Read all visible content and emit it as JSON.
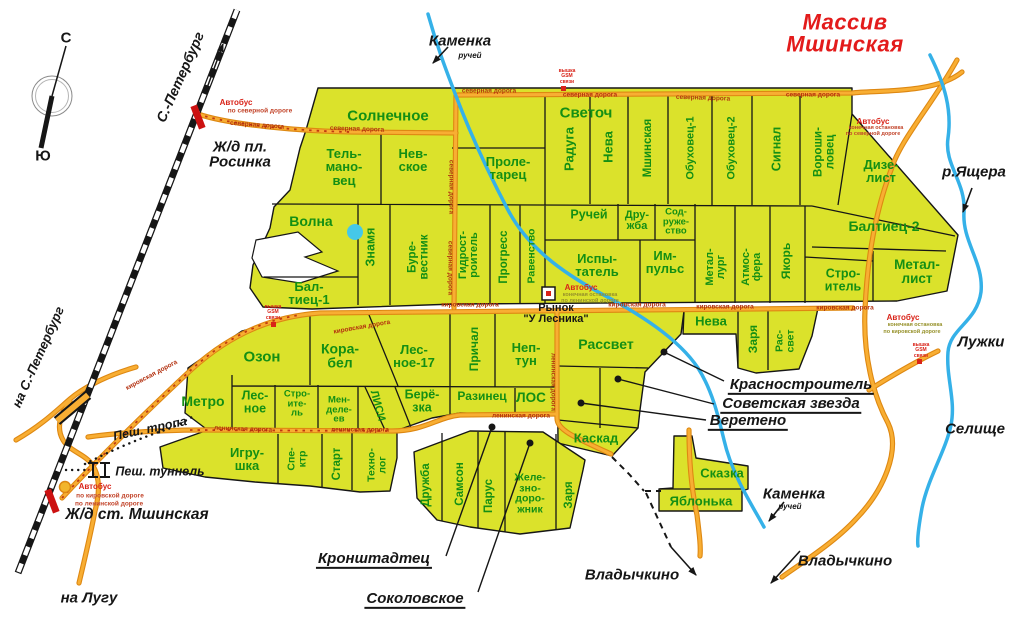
{
  "map_title": "Массив Мшинская",
  "colors": {
    "plot_fill": "#dbe22b",
    "plot_text": "#148f14",
    "road": "#f8ae33",
    "road_casing": "#de8812",
    "river": "#35b1e8",
    "title_red": "#e31b1b",
    "route_dash": "#c03a10"
  },
  "labels": [
    {
      "name": "plot-solnechnoe",
      "text": "Солнечное",
      "x": 388,
      "y": 116,
      "fs": 15,
      "cls": "plot"
    },
    {
      "name": "plot-svetoch",
      "text": "Светоч",
      "x": 586,
      "y": 113,
      "fs": 15,
      "cls": "plot"
    },
    {
      "name": "plot-raduga",
      "text": "Радуга",
      "x": 569,
      "y": 149,
      "rot": -90,
      "fs": 13,
      "cls": "plot"
    },
    {
      "name": "plot-neva-north",
      "text": "Нева",
      "x": 608,
      "y": 147,
      "rot": -90,
      "fs": 13,
      "cls": "plot"
    },
    {
      "name": "plot-mshinskaya",
      "text": "Мшинская",
      "x": 649,
      "y": 148,
      "rot": -90,
      "fs": 11.5,
      "cls": "plot"
    },
    {
      "name": "plot-obukhovec-1",
      "text": "Обуховец-1",
      "x": 691,
      "y": 148,
      "rot": -90,
      "fs": 11,
      "cls": "plot"
    },
    {
      "name": "plot-obukhovec-2",
      "text": "Обуховец-2",
      "x": 732,
      "y": 148,
      "rot": -90,
      "fs": 11,
      "cls": "plot"
    },
    {
      "name": "plot-signal",
      "text": "Сигнал",
      "x": 777,
      "y": 149,
      "rot": -90,
      "fs": 12.5,
      "cls": "plot"
    },
    {
      "name": "plot-voroshilovec",
      "text": "Вороши-\nловец",
      "x": 825,
      "y": 152,
      "rot": -90,
      "fs": 11.5,
      "cls": "plot"
    },
    {
      "name": "plot-dizelist",
      "text": "Дизе-\nлист",
      "x": 881,
      "y": 171,
      "fs": 13,
      "cls": "plot"
    },
    {
      "name": "plot-telmanovec",
      "text": "Тель-\nмано-\nвец",
      "x": 344,
      "y": 167,
      "fs": 13,
      "cls": "plot"
    },
    {
      "name": "plot-nevskoe",
      "text": "Нев-\nское",
      "x": 413,
      "y": 160,
      "fs": 13,
      "cls": "plot"
    },
    {
      "name": "plot-proletarec",
      "text": "Проле-\nтарец",
      "x": 508,
      "y": 168,
      "fs": 13,
      "cls": "plot"
    },
    {
      "name": "plot-ruchej",
      "text": "Ручей",
      "x": 589,
      "y": 215,
      "fs": 12.5,
      "cls": "plot"
    },
    {
      "name": "plot-druzhba-north",
      "text": "Дру-\nжба",
      "x": 637,
      "y": 221,
      "fs": 11,
      "cls": "plot"
    },
    {
      "name": "plot-sodruzhestvo",
      "text": "Сод-\nруже-\nство",
      "x": 676,
      "y": 222,
      "fs": 9.5,
      "cls": "plot"
    },
    {
      "name": "plot-volna",
      "text": "Волна",
      "x": 311,
      "y": 221,
      "fs": 14,
      "cls": "plot"
    },
    {
      "name": "plot-znamya",
      "text": "Знамя",
      "x": 371,
      "y": 247,
      "rot": -90,
      "fs": 12.5,
      "cls": "plot"
    },
    {
      "name": "plot-burevestnik",
      "text": "Буре-\nвестник",
      "x": 419,
      "y": 257,
      "rot": -90,
      "fs": 11.5,
      "cls": "plot"
    },
    {
      "name": "plot-gidrostroitel",
      "text": "Гидрост-\nроитель",
      "x": 469,
      "y": 255,
      "rot": -90,
      "fs": 11,
      "cls": "plot"
    },
    {
      "name": "plot-progress",
      "text": "Прогресс",
      "x": 505,
      "y": 257,
      "rot": -90,
      "fs": 11.5,
      "cls": "plot"
    },
    {
      "name": "plot-ravenstvo",
      "text": "Равенство",
      "x": 532,
      "y": 256,
      "rot": -90,
      "fs": 10.5,
      "cls": "plot"
    },
    {
      "name": "plot-ispytatel",
      "text": "Испы-\nтатель",
      "x": 597,
      "y": 265,
      "fs": 13,
      "cls": "plot"
    },
    {
      "name": "plot-impuls",
      "text": "Им-\nпульс",
      "x": 665,
      "y": 262,
      "fs": 13,
      "cls": "plot"
    },
    {
      "name": "plot-metallurg",
      "text": "Метал-\nлург",
      "x": 716,
      "y": 267,
      "rot": -90,
      "fs": 11,
      "cls": "plot"
    },
    {
      "name": "plot-atmosfera",
      "text": "Атмос-\nфера",
      "x": 752,
      "y": 267,
      "rot": -90,
      "fs": 11,
      "cls": "plot"
    },
    {
      "name": "plot-yakor",
      "text": "Якорь",
      "x": 786,
      "y": 261,
      "rot": -90,
      "fs": 12,
      "cls": "plot"
    },
    {
      "name": "plot-baltiec-2",
      "text": "Балтиец-2",
      "x": 884,
      "y": 226,
      "fs": 14,
      "cls": "plot"
    },
    {
      "name": "plot-metallist",
      "text": "Метал-\nлист",
      "x": 917,
      "y": 272,
      "fs": 13.5,
      "cls": "plot"
    },
    {
      "name": "plot-stroitel-east",
      "text": "Стро-\nитель",
      "x": 843,
      "y": 280,
      "fs": 12.5,
      "cls": "plot"
    },
    {
      "name": "plot-baltiec-1",
      "text": "Бал-\nтиец-1",
      "x": 309,
      "y": 293,
      "fs": 13,
      "cls": "plot"
    },
    {
      "name": "plot-ozon",
      "text": "Озон",
      "x": 262,
      "y": 357,
      "fs": 15,
      "cls": "plot"
    },
    {
      "name": "plot-korabel",
      "text": "Кора-\nбел",
      "x": 340,
      "y": 356,
      "fs": 14,
      "cls": "plot"
    },
    {
      "name": "plot-lesnoe-17",
      "text": "Лес-\nное-17",
      "x": 414,
      "y": 356,
      "fs": 13,
      "cls": "plot"
    },
    {
      "name": "plot-prichal",
      "text": "Причал",
      "x": 474,
      "y": 349,
      "rot": -90,
      "fs": 12,
      "cls": "plot"
    },
    {
      "name": "plot-neptun",
      "text": "Неп-\nтун",
      "x": 526,
      "y": 354,
      "fs": 13,
      "cls": "plot"
    },
    {
      "name": "plot-rassvet",
      "text": "Рассвет",
      "x": 606,
      "y": 344,
      "fs": 14,
      "cls": "plot"
    },
    {
      "name": "plot-neva-2",
      "text": "Нева",
      "x": 711,
      "y": 321,
      "fs": 13,
      "cls": "plot"
    },
    {
      "name": "plot-zarya-2",
      "text": "Заря",
      "x": 753,
      "y": 339,
      "rot": -90,
      "fs": 12,
      "cls": "plot"
    },
    {
      "name": "plot-rassvet-2",
      "text": "Рас-\nсвет",
      "x": 785,
      "y": 341,
      "rot": -90,
      "fs": 10.5,
      "cls": "plot"
    },
    {
      "name": "plot-metro",
      "text": "Метро",
      "x": 203,
      "y": 401,
      "fs": 14,
      "cls": "plot"
    },
    {
      "name": "plot-lesnoe",
      "text": "Лес-\nное",
      "x": 255,
      "y": 402,
      "fs": 12.5,
      "cls": "plot"
    },
    {
      "name": "plot-stroitel-2",
      "text": "Стро-\nите-\nль",
      "x": 297,
      "y": 404,
      "fs": 9.5,
      "cls": "plot"
    },
    {
      "name": "plot-mendeleev",
      "text": "Мен-\nделе-\nев",
      "x": 339,
      "y": 410,
      "fs": 9.5,
      "cls": "plot"
    },
    {
      "name": "plot-lisi",
      "text": "ЛИСИ",
      "x": 377,
      "y": 406,
      "rot": 75,
      "fs": 11,
      "cls": "plot"
    },
    {
      "name": "plot-beryozka",
      "text": "Берё-\nзка",
      "x": 422,
      "y": 401,
      "fs": 12.5,
      "cls": "plot"
    },
    {
      "name": "plot-razinec",
      "text": "Разинец",
      "x": 482,
      "y": 396,
      "fs": 12,
      "cls": "plot"
    },
    {
      "name": "plot-los",
      "text": "ЛОС",
      "x": 531,
      "y": 398,
      "fs": 13.5,
      "cls": "plot"
    },
    {
      "name": "plot-igrushka",
      "text": "Игру-\nшка",
      "x": 247,
      "y": 459,
      "fs": 13,
      "cls": "plot"
    },
    {
      "name": "plot-spektr",
      "text": "Спе-\nктр",
      "x": 297,
      "y": 459,
      "rot": -90,
      "fs": 10.5,
      "cls": "plot"
    },
    {
      "name": "plot-start",
      "text": "Старт",
      "x": 338,
      "y": 464,
      "rot": -90,
      "fs": 11.5,
      "cls": "plot"
    },
    {
      "name": "plot-tekhnolog",
      "text": "Техно-\nлог",
      "x": 377,
      "y": 465,
      "rot": -90,
      "fs": 10.5,
      "cls": "plot"
    },
    {
      "name": "plot-druzhba-2",
      "text": "Дружба",
      "x": 427,
      "y": 485,
      "rot": -90,
      "fs": 11.5,
      "cls": "plot"
    },
    {
      "name": "plot-samson",
      "text": "Самсон",
      "x": 461,
      "y": 484,
      "rot": -90,
      "fs": 11.5,
      "cls": "plot"
    },
    {
      "name": "plot-parus",
      "text": "Парус",
      "x": 490,
      "y": 496,
      "rot": -90,
      "fs": 11.5,
      "cls": "plot"
    },
    {
      "name": "plot-zheleznodorozhnik",
      "text": "Желе-\nзно-\nдоро-\nжник",
      "x": 530,
      "y": 494,
      "fs": 10.5,
      "cls": "plot"
    },
    {
      "name": "plot-zarya-3",
      "text": "Заря",
      "x": 570,
      "y": 495,
      "rot": -90,
      "fs": 11.5,
      "cls": "plot"
    },
    {
      "name": "plot-kaskad",
      "text": "Каскад",
      "x": 596,
      "y": 438,
      "fs": 13,
      "cls": "plot"
    },
    {
      "name": "plot-skazka",
      "text": "Сказка",
      "x": 722,
      "y": 473,
      "fs": 13,
      "cls": "plot"
    },
    {
      "name": "plot-yablonka",
      "text": "Яблонька",
      "x": 701,
      "y": 501,
      "fs": 13,
      "cls": "plot"
    },
    {
      "name": "callout-krasnostroitel",
      "text": "Красностроитель",
      "x": 801,
      "y": 386,
      "fs": 15,
      "cls": "callout"
    },
    {
      "name": "callout-sovetskaya-zvezda",
      "text": "Советская звезда",
      "x": 791,
      "y": 405,
      "fs": 15,
      "cls": "callout"
    },
    {
      "name": "callout-vereteno",
      "text": "Веретено",
      "x": 748,
      "y": 422,
      "fs": 15,
      "cls": "callout"
    },
    {
      "name": "callout-kronshtadtec",
      "text": "Кронштадтец",
      "x": 374,
      "y": 560,
      "fs": 15,
      "cls": "callout"
    },
    {
      "name": "callout-sokolovskoe",
      "text": "Соколовское",
      "x": 415,
      "y": 600,
      "fs": 15,
      "cls": "callout"
    },
    {
      "name": "map-title",
      "text": "Массив Мшинская",
      "x": 845,
      "y": 34,
      "fs": 22,
      "cls": "title"
    },
    {
      "name": "place-kamenka-north",
      "text": "Каменка",
      "x": 460,
      "y": 41,
      "fs": 15,
      "cls": "place"
    },
    {
      "name": "place-kamenka-north-sub",
      "text": "ручей",
      "x": 470,
      "y": 56,
      "fs": 8,
      "cls": "place"
    },
    {
      "name": "place-kamenka-south",
      "text": "Каменка",
      "x": 794,
      "y": 494,
      "fs": 15,
      "cls": "place"
    },
    {
      "name": "place-kamenka-south-sub",
      "text": "ручей",
      "x": 790,
      "y": 507,
      "fs": 8,
      "cls": "place"
    },
    {
      "name": "place-yashchera",
      "text": "р.Ящера",
      "x": 974,
      "y": 172,
      "fs": 15,
      "cls": "place"
    },
    {
      "name": "place-luzhki",
      "text": "Лужки",
      "x": 981,
      "y": 342,
      "fs": 15,
      "cls": "place"
    },
    {
      "name": "place-selishche",
      "text": "Селище",
      "x": 975,
      "y": 429,
      "fs": 15,
      "cls": "place"
    },
    {
      "name": "place-vladychkino-west",
      "text": "Владычкино",
      "x": 632,
      "y": 575,
      "fs": 15,
      "cls": "place"
    },
    {
      "name": "place-vladychkino-east",
      "text": "Владычкино",
      "x": 845,
      "y": 561,
      "fs": 15,
      "cls": "place"
    },
    {
      "name": "place-na-lugu",
      "text": "на Лугу",
      "x": 89,
      "y": 598,
      "fs": 15,
      "cls": "place"
    },
    {
      "name": "place-zhd-rosinka",
      "text": "Ж/д пл.\nРосинка",
      "x": 240,
      "y": 155,
      "fs": 15,
      "cls": "place"
    },
    {
      "name": "place-zhd-mshinskaya",
      "text": "Ж/д ст. Мшинская",
      "x": 137,
      "y": 515,
      "fs": 15.5,
      "cls": "place"
    },
    {
      "name": "place-spb-top",
      "text": "С.-Петербург",
      "x": 180,
      "y": 77,
      "rot": -66,
      "fs": 14,
      "cls": "place"
    },
    {
      "name": "place-na-spb",
      "text": "на С.-Петербург",
      "x": 38,
      "y": 357,
      "rot": -66,
      "fs": 13,
      "cls": "place"
    },
    {
      "name": "compass-north",
      "text": "С",
      "x": 66,
      "y": 38,
      "fs": 15,
      "cls": "compassL"
    },
    {
      "name": "compass-south",
      "text": "Ю",
      "x": 43,
      "y": 156,
      "fs": 15,
      "cls": "compassL"
    },
    {
      "name": "place-pesh-tropa",
      "text": "Пеш. тропа",
      "x": 150,
      "y": 429,
      "rot": -12,
      "fs": 12.5,
      "cls": "place"
    },
    {
      "name": "place-pesh-tunnel",
      "text": "Пеш. туннель",
      "x": 160,
      "y": 472,
      "fs": 12.5,
      "cls": "place"
    },
    {
      "name": "market-label",
      "text": "Рынок\n\"У Лесника\"",
      "x": 556,
      "y": 314,
      "fs": 11,
      "cls": "market"
    },
    {
      "name": "road-severnaya-1",
      "text": "северная дорога",
      "x": 257,
      "y": 126,
      "rot": 4,
      "fs": 6.5,
      "cls": "road"
    },
    {
      "name": "road-severnaya-2",
      "text": "северная дорога",
      "x": 357,
      "y": 130,
      "rot": 2,
      "fs": 6.5,
      "cls": "road"
    },
    {
      "name": "road-severnaya-3",
      "text": "северная дорога",
      "x": 489,
      "y": 92,
      "fs": 6.5,
      "cls": "road"
    },
    {
      "name": "road-severnaya-4",
      "text": "северная дорога",
      "x": 590,
      "y": 96,
      "fs": 6.5,
      "cls": "road"
    },
    {
      "name": "road-severnaya-5",
      "text": "северная дорога",
      "x": 703,
      "y": 99,
      "rot": 2,
      "fs": 6.5,
      "cls": "road"
    },
    {
      "name": "road-severnaya-6",
      "text": "северная дорога",
      "x": 813,
      "y": 96,
      "fs": 6.5,
      "cls": "road"
    },
    {
      "name": "road-severnaya-v1",
      "text": "северная дорога",
      "x": 450,
      "y": 187,
      "rot": 90,
      "fs": 6.5,
      "cls": "road"
    },
    {
      "name": "road-severnaya-v2",
      "text": "северная дорога",
      "x": 449,
      "y": 268,
      "rot": 90,
      "fs": 6.5,
      "cls": "road"
    },
    {
      "name": "road-kirovskaya-1",
      "text": "кировская дорога",
      "x": 152,
      "y": 376,
      "rot": -28,
      "fs": 6.5,
      "cls": "road"
    },
    {
      "name": "road-kirovskaya-2",
      "text": "кировская дорога",
      "x": 362,
      "y": 328,
      "rot": -10,
      "fs": 6.5,
      "cls": "road"
    },
    {
      "name": "road-kirovskaya-3",
      "text": "кировская дорога",
      "x": 470,
      "y": 306,
      "fs": 6.5,
      "cls": "road"
    },
    {
      "name": "road-kirovskaya-4",
      "text": "кировская дорога",
      "x": 637,
      "y": 306,
      "fs": 6.5,
      "cls": "road"
    },
    {
      "name": "road-kirovskaya-5",
      "text": "кировская дорога",
      "x": 725,
      "y": 308,
      "fs": 6.5,
      "cls": "road"
    },
    {
      "name": "road-kirovskaya-6",
      "text": "кировская дорога",
      "x": 845,
      "y": 309,
      "fs": 6.5,
      "cls": "road"
    },
    {
      "name": "road-leninskaya-1",
      "text": "ленинская дорога",
      "x": 243,
      "y": 430,
      "rot": 2,
      "fs": 6.5,
      "cls": "road"
    },
    {
      "name": "road-leninskaya-2",
      "text": "ленинская дорога",
      "x": 360,
      "y": 431,
      "fs": 6.5,
      "cls": "road"
    },
    {
      "name": "road-leninskaya-3",
      "text": "ленинская дорога",
      "x": 521,
      "y": 417,
      "fs": 6.5,
      "cls": "road"
    },
    {
      "name": "road-leninskaya-v",
      "text": "ленинская дорога",
      "x": 552,
      "y": 382,
      "rot": 90,
      "fs": 6.5,
      "cls": "road"
    },
    {
      "name": "bus-stop-1-title",
      "text": "Автобус",
      "x": 236,
      "y": 103,
      "fs": 8,
      "cls": "bus"
    },
    {
      "name": "bus-stop-1-sub",
      "text": "по северной дороге",
      "x": 260,
      "y": 112,
      "fs": 6.5,
      "cls": "bussub"
    },
    {
      "name": "bus-stop-2-title",
      "text": "Автобус",
      "x": 873,
      "y": 122,
      "fs": 8,
      "cls": "bus"
    },
    {
      "name": "bus-stop-2-sub1",
      "text": "конечная остановка",
      "x": 876,
      "y": 129,
      "fs": 5.5,
      "cls": "bussub"
    },
    {
      "name": "bus-stop-2-sub2",
      "text": "по северной дороге",
      "x": 873,
      "y": 135,
      "fs": 5.5,
      "cls": "bussub"
    },
    {
      "name": "bus-stop-3-title",
      "text": "Автобус",
      "x": 581,
      "y": 288,
      "fs": 8,
      "cls": "bus"
    },
    {
      "name": "bus-stop-3-sub1",
      "text": "конечная остановка",
      "x": 590,
      "y": 296,
      "fs": 5.5,
      "cls": "bussub2"
    },
    {
      "name": "bus-stop-3-sub2",
      "text": "по ленинской дороге",
      "x": 590,
      "y": 302,
      "fs": 5.5,
      "cls": "bussub2"
    },
    {
      "name": "bus-stop-4-title",
      "text": "Автобус",
      "x": 903,
      "y": 318,
      "fs": 8,
      "cls": "bus"
    },
    {
      "name": "bus-stop-4-sub1",
      "text": "конечная остановка",
      "x": 915,
      "y": 326,
      "fs": 5.5,
      "cls": "bussub2"
    },
    {
      "name": "bus-stop-4-sub2",
      "text": "по кировской дороге",
      "x": 912,
      "y": 333,
      "fs": 5.5,
      "cls": "bussub2"
    },
    {
      "name": "bus-stop-5-title",
      "text": "Автобус",
      "x": 95,
      "y": 487,
      "fs": 8,
      "cls": "bus"
    },
    {
      "name": "bus-stop-5-sub1",
      "text": "по кировской дороге",
      "x": 110,
      "y": 497,
      "fs": 6.5,
      "cls": "bussub"
    },
    {
      "name": "bus-stop-5-sub2",
      "text": "по ленинской дороге",
      "x": 109,
      "y": 505,
      "fs": 6.5,
      "cls": "bussub"
    },
    {
      "name": "gsm-tower-1",
      "text": "вышка\nGSM\nсвязи",
      "x": 567,
      "y": 77,
      "fs": 5,
      "cls": "gsm"
    },
    {
      "name": "gsm-tower-2",
      "text": "вышка\nGSM\nсвязи",
      "x": 273,
      "y": 313,
      "fs": 5,
      "cls": "gsm"
    },
    {
      "name": "gsm-tower-3",
      "text": "вышка\nGSM\nсвязи",
      "x": 921,
      "y": 351,
      "fs": 5,
      "cls": "gsm"
    }
  ]
}
